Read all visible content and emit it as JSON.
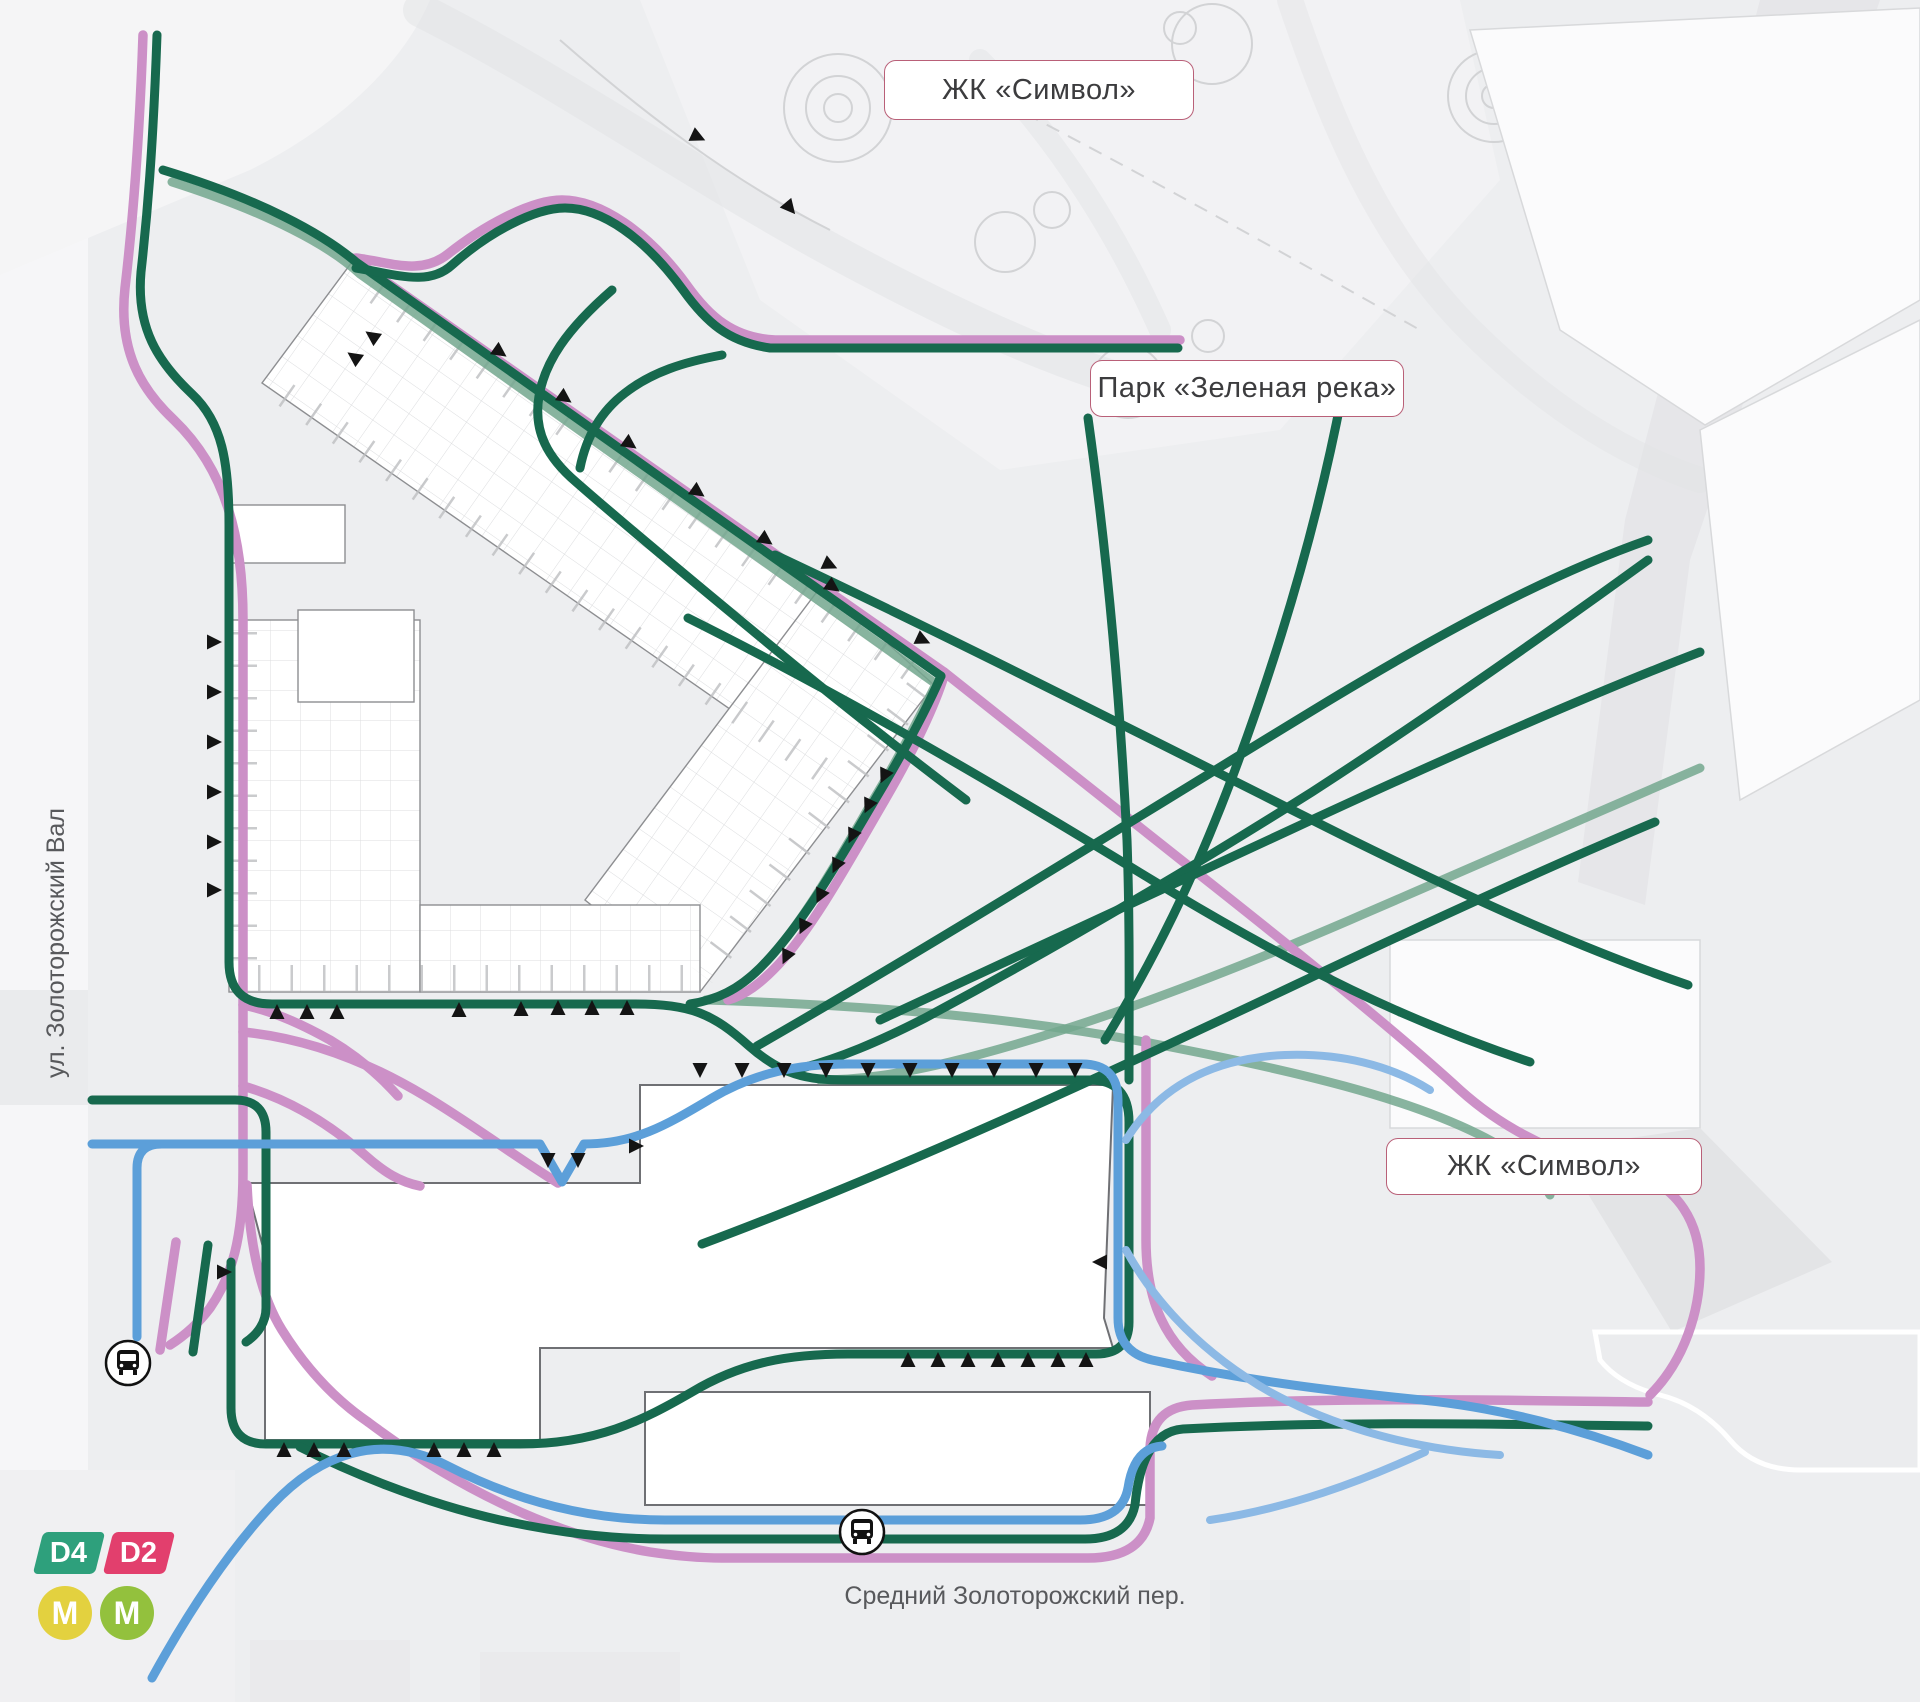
{
  "labels": {
    "complex_top": "ЖК «Символ»",
    "park": "Парк «Зеленая река»",
    "complex_right": "ЖК «Символ»",
    "street_left": "ул. Золоторожский Вал",
    "street_bottom": "Средний Золоторожский пер."
  },
  "legend": {
    "d4": {
      "label": "D4",
      "color": "#2ea07c"
    },
    "d2": {
      "label": "D2",
      "color": "#e23f6d"
    },
    "metro_1": {
      "label": "М",
      "color": "#e3d13f"
    },
    "metro_2": {
      "label": "М",
      "color": "#93c13d"
    }
  },
  "colors": {
    "background": "#edeef0",
    "building_fill": "#ffffff",
    "building_stroke": "#8d8e91",
    "plan_line": "#c7c8ca",
    "route_green": "#17694e",
    "route_green_faded": "#73a78e",
    "route_pink": "#cc90c7",
    "route_blue": "#5c9fd9",
    "route_blue_light": "#8cb9e5",
    "arrow": "#141414",
    "label_border": "#b96078",
    "label_text": "#3c3c3e",
    "street_text": "#58595c"
  },
  "icons": {
    "bus_stop": "bus-stop-icon"
  }
}
